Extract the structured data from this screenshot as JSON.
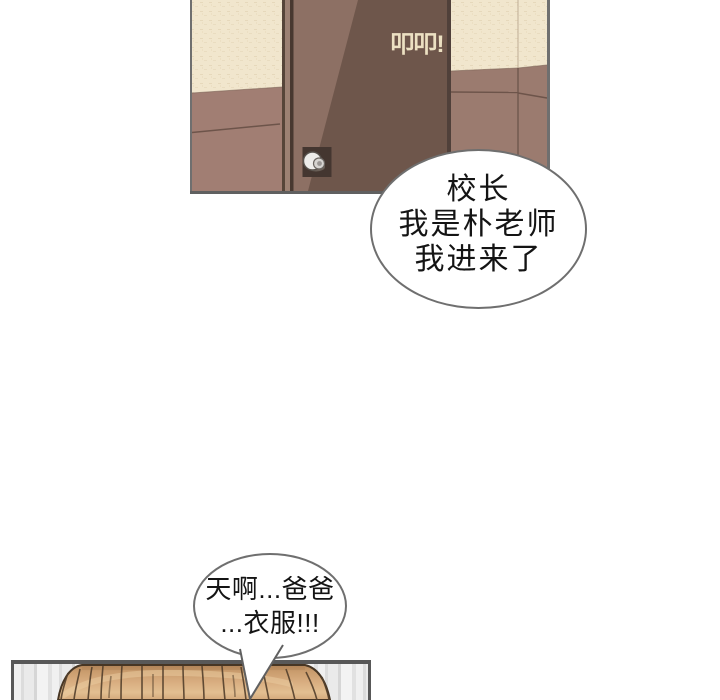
{
  "page": {
    "width_px": 720,
    "height_px": 700,
    "background": "#ffffff"
  },
  "panel_door": {
    "description": "closed door with knock sound effect",
    "sfx": "叩叩!",
    "colors": {
      "wallpaper_cream": "#f1e6cd",
      "wall_mauve": "#a17e73",
      "door_dark": "#6e564b",
      "door_light": "#8d7064",
      "sfx_text": "#ece0c2",
      "panel_border": "#6f6f6f"
    }
  },
  "panel_hall": {
    "description": "striped wall with top of a head of hair",
    "colors": {
      "stripe_light": "#f1f1f1",
      "stripe_dark": "#d6d6d6",
      "hair_base": "#d2a577",
      "hair_outline": "#473624",
      "panel_border": "#585858"
    }
  },
  "speech": {
    "principal": {
      "lines": [
        "校长",
        "我是朴老师",
        "我进来了"
      ]
    },
    "shock": {
      "lines": [
        "天啊...爸爸",
        "...衣服!!!"
      ]
    }
  }
}
